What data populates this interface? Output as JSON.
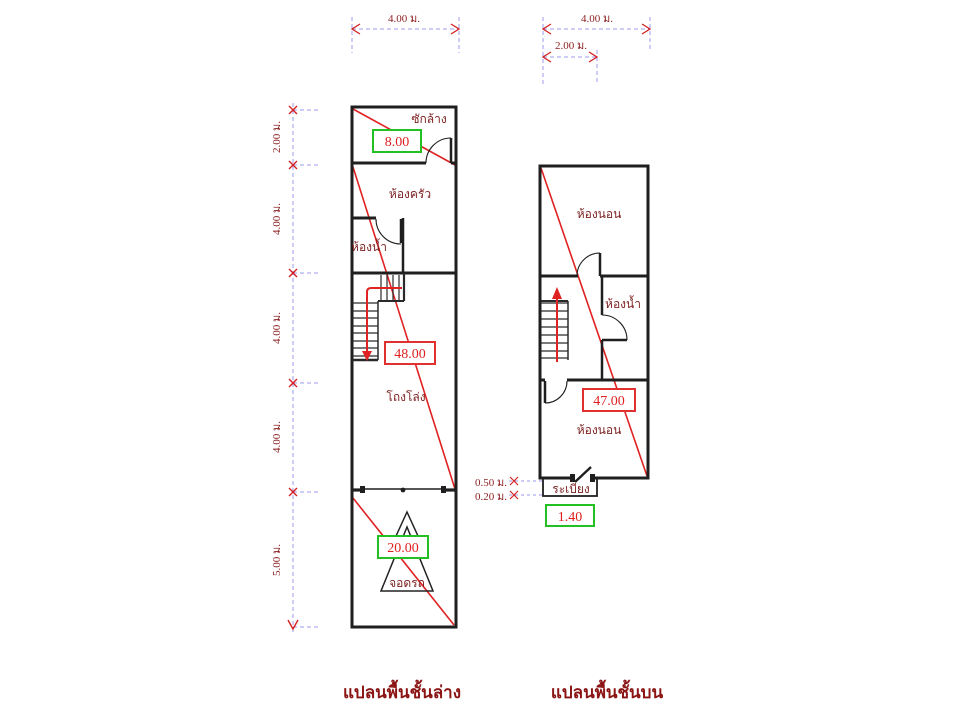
{
  "captions": {
    "floor1": "แปลนพื้นชั้นล่าง",
    "floor2": "แปลนพื้นชั้นบน"
  },
  "floor1": {
    "rooms": {
      "laundry": "ซักล้าง",
      "kitchen": "ห้องครัว",
      "bathroom": "ห้องน้ำ",
      "hall": "โถงโล่ง",
      "parking": "จอดรถ"
    },
    "areas": {
      "laundry": "8.00",
      "hall": "48.00",
      "parking": "20.00"
    }
  },
  "floor2": {
    "rooms": {
      "bedroom1": "ห้องนอน",
      "bathroom": "ห้องน้ำ",
      "bedroom2": "ห้องนอน",
      "balcony": "ระเบียง"
    },
    "areas": {
      "total": "47.00",
      "balcony": "1.40"
    }
  },
  "dimensions": {
    "top_left_width": "4.00 ม.",
    "top_right_width": "4.00 ม.",
    "top_right_half": "2.00 ม.",
    "left_chain": [
      "2.00 ม.",
      "4.00 ม.",
      "4.00 ม.",
      "4.00 ม.",
      "5.00 ม."
    ],
    "balcony_offsets": [
      "0.50 ม.",
      "0.20 ม."
    ]
  },
  "colors": {
    "wall": "#1f1f1f",
    "red_line": "#e02222",
    "green_box": "#22c022",
    "red_box": "#e03030",
    "dim_line": "#9b9bf0",
    "label_text": "#7b1f1f"
  }
}
